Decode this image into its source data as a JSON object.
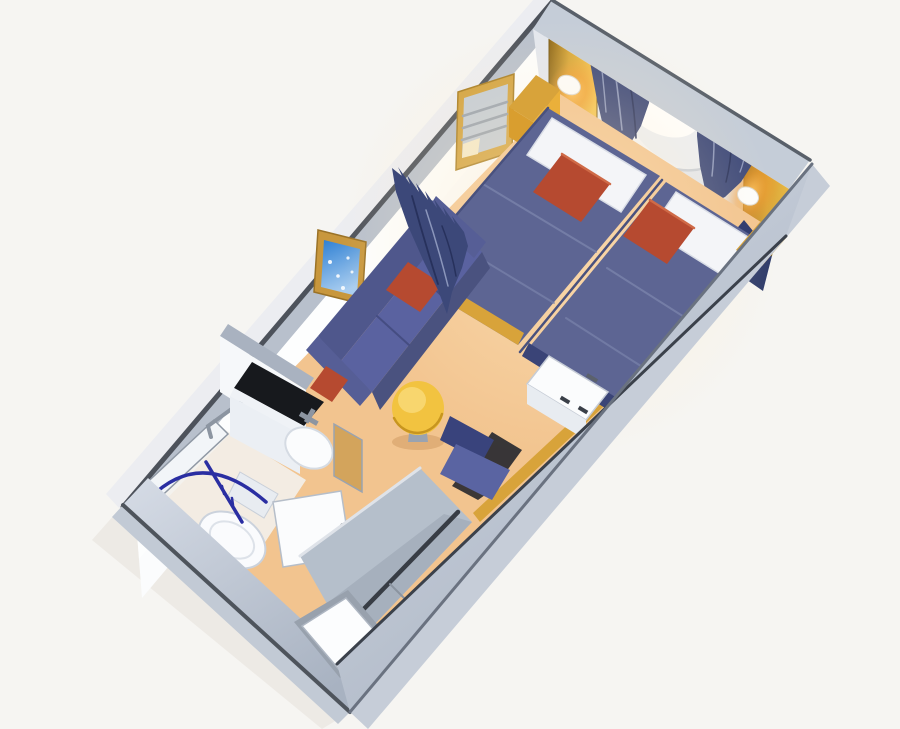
{
  "scene": {
    "description": "3D isometric cutaway rendering of a ship stateroom floor plan",
    "view": "isometric-cutaway",
    "areas": [
      {
        "name": "sleeping-area",
        "items": [
          "porthole-window",
          "window-curtain-left",
          "window-curtain-right",
          "wall-lamp-left",
          "wall-lamp-right",
          "twin-bed-left",
          "twin-bed-right",
          "white-pillows",
          "red-accent-pillows",
          "gold-nightstand",
          "wall-mirror",
          "headboard-panel"
        ]
      },
      {
        "name": "sitting-area",
        "items": [
          "sofa",
          "sofa-red-pillows",
          "framed-picture",
          "divider-curtain",
          "round-coffee-table",
          "desk-chair",
          "vanity-desk"
        ]
      },
      {
        "name": "bathroom",
        "items": [
          "vanity-counter",
          "sink",
          "faucet",
          "toilet",
          "shower-stall",
          "shower-curtain-rail",
          "towel-bar",
          "bathroom-door-open",
          "bathroom-door-tan"
        ]
      },
      {
        "name": "entry-corridor",
        "items": [
          "closet-panels",
          "closet-rail",
          "entry-door"
        ]
      }
    ]
  },
  "colors": {
    "background": "#f6f5f2",
    "carpet": "#f2c48f",
    "wall_white": "#fbfcfd",
    "wall_gray": "#b9c2ce",
    "wall_trim": "#4e545c",
    "headboard_navy": "#2d3a69",
    "bed_blanket": "#5d6593",
    "curtain_navy": "#3c4879",
    "accent_red": "#b64a30",
    "accent_gold": "#d8a33a",
    "table_yellow": "#f2c340",
    "sofa_blue": "#5a62a0",
    "pillow_white": "#f4f5f8",
    "porthole_white": "#fdfdfe",
    "lamp_glow": "#f59a2e",
    "shower_rail_blue": "#2a2ea2"
  }
}
